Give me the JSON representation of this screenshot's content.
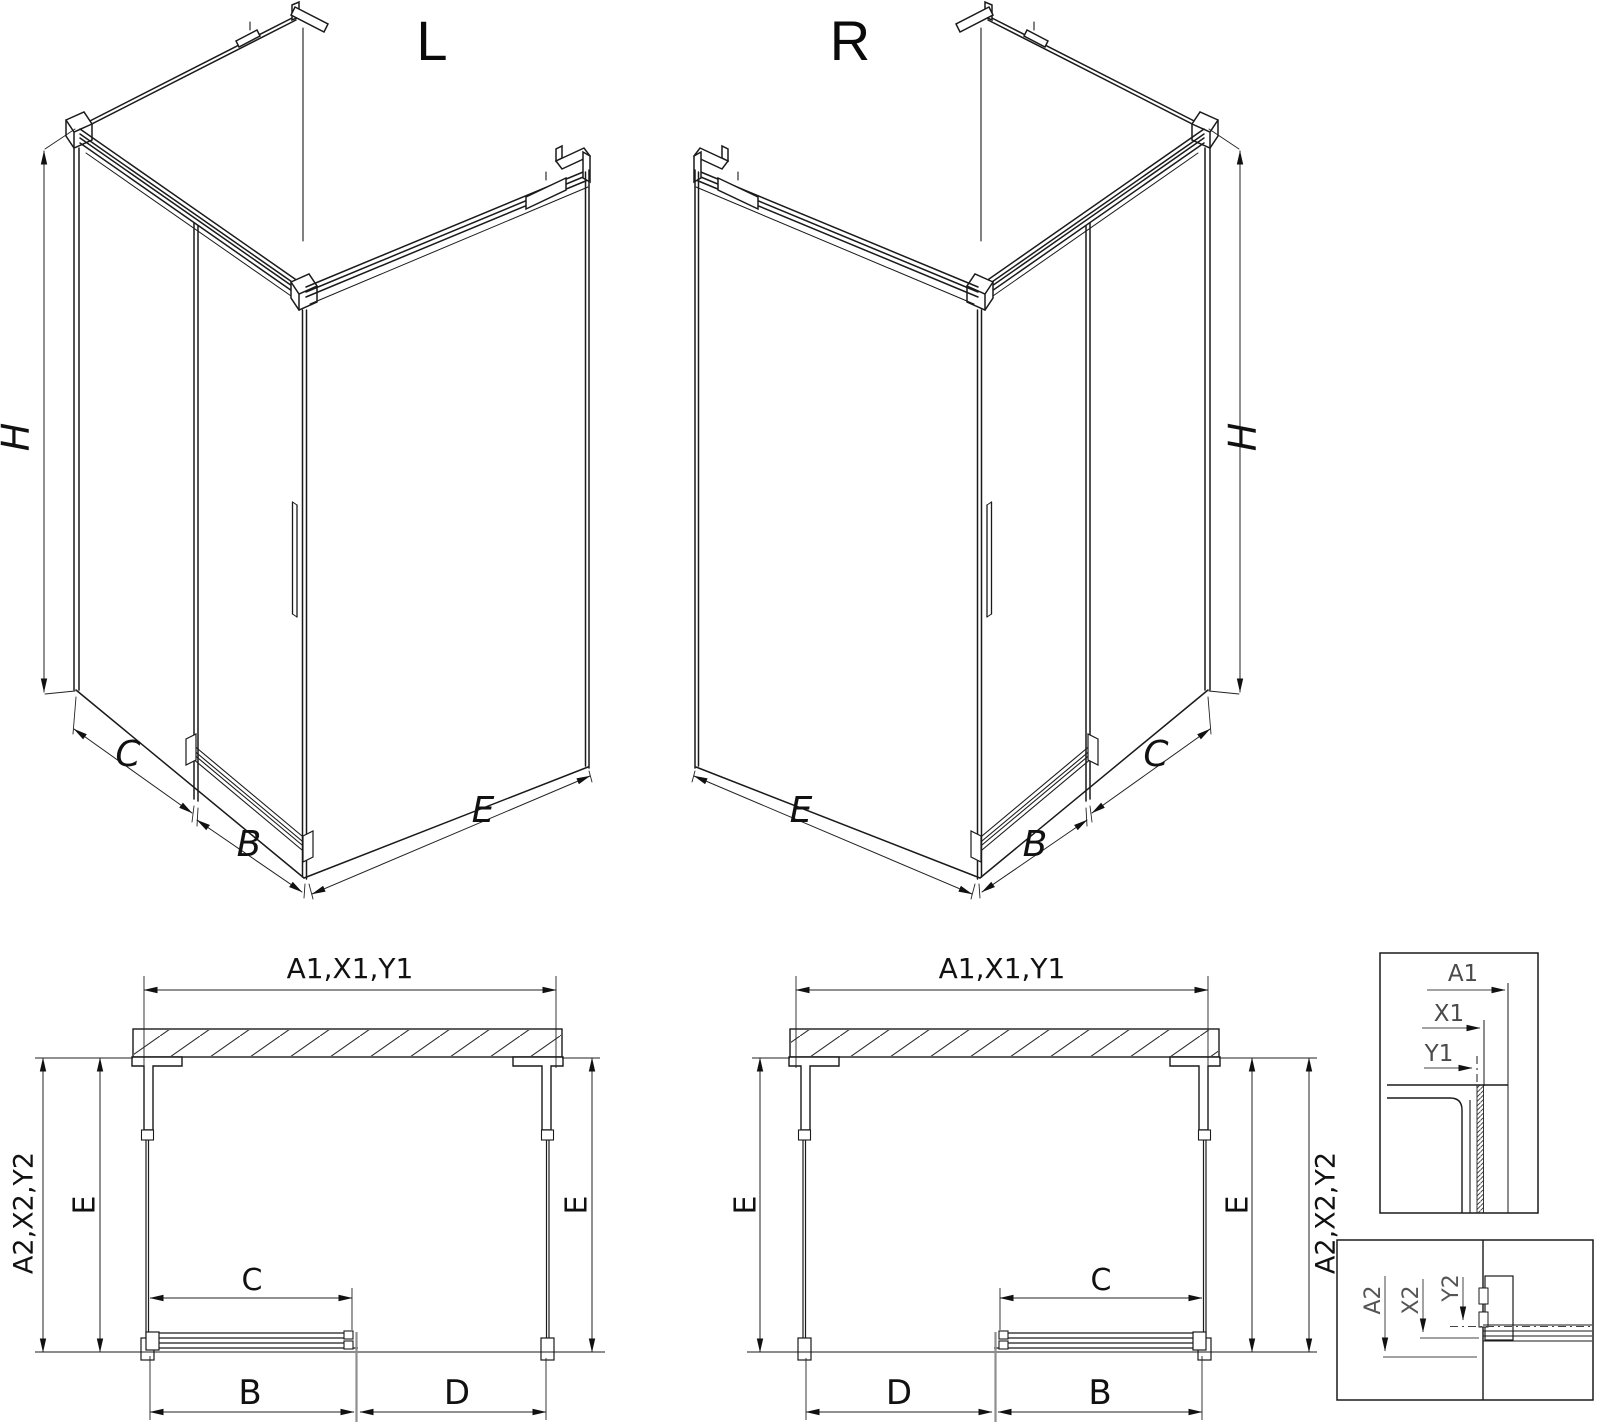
{
  "views": {
    "iso_left": {
      "title": "L",
      "dim_h": "H",
      "dim_c": "C",
      "dim_b": "B",
      "dim_e": "E"
    },
    "iso_right": {
      "title": "R",
      "dim_h": "H",
      "dim_c": "C",
      "dim_b": "B",
      "dim_e": "E"
    },
    "plan_left": {
      "dim_width": "A1,X1,Y1",
      "dim_depth": "A2,X2,Y2",
      "dim_e_left": "E",
      "dim_e_right": "E",
      "dim_c": "C",
      "dim_b": "B",
      "dim_d": "D"
    },
    "plan_right": {
      "dim_width": "A1,X1,Y1",
      "dim_depth": "A2,X2,Y2",
      "dim_e_left": "E",
      "dim_e_right": "E",
      "dim_c": "C",
      "dim_b": "B",
      "dim_d": "D"
    },
    "detail_width": {
      "dim_a": "A1",
      "dim_x": "X1",
      "dim_y": "Y1"
    },
    "detail_depth": {
      "dim_a": "A2",
      "dim_x": "X2",
      "dim_y": "Y2"
    }
  },
  "colors": {
    "line": "#1a1a1a",
    "dimension": "#222222",
    "detail_label": "#4a4a4a",
    "door_edge_gray": "#8f8f8f",
    "background": "#ffffff"
  }
}
